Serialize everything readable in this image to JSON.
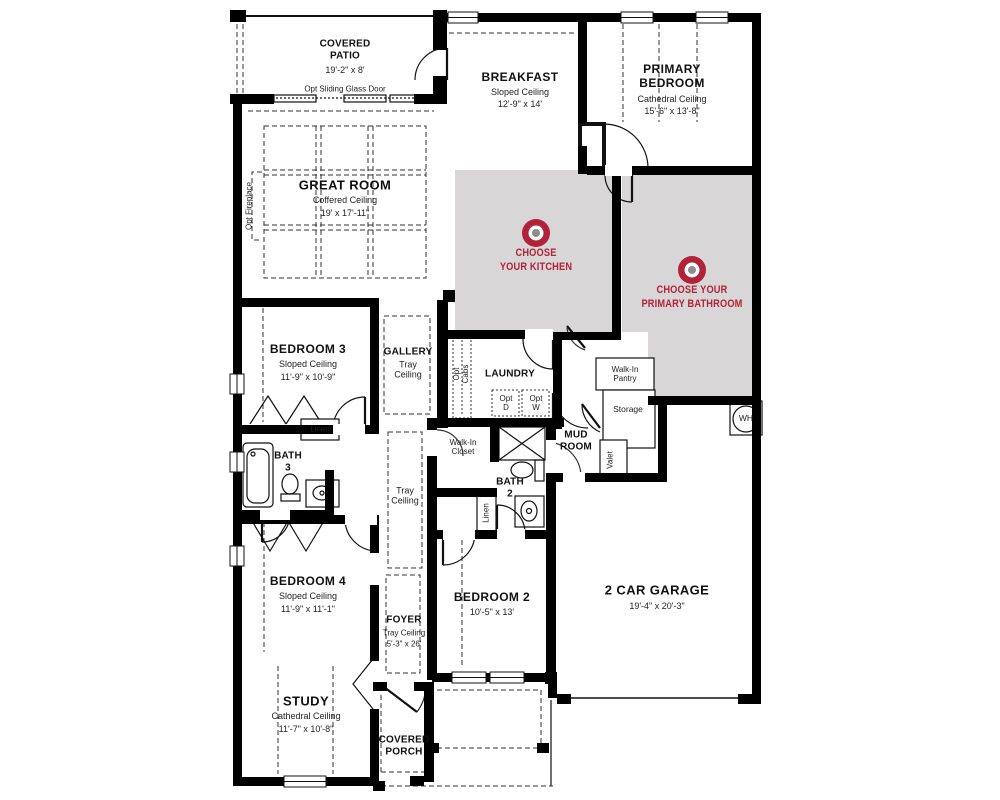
{
  "palette": {
    "wall": "#000000",
    "zone_gray": "#d9d6d8",
    "accent_red": "#b02338",
    "target_dot_gray": "#8a8f8a"
  },
  "rooms": {
    "covered_patio": {
      "name": "COVERED\nPATIO",
      "dims": "19'-2\" x 8'"
    },
    "breakfast": {
      "name": "BREAKFAST",
      "ceiling": "Sloped Ceiling",
      "dims": "12'-9\" x 14'"
    },
    "primary_bedroom": {
      "name": "PRIMARY\nBEDROOM",
      "ceiling": "Cathedral Ceiling",
      "dims": "15'-6\" x 13'-8\""
    },
    "great_room": {
      "name": "GREAT ROOM",
      "ceiling": "Coffered Ceiling",
      "dims": "19' x 17'-11\""
    },
    "bedroom3": {
      "name": "BEDROOM 3",
      "ceiling": "Sloped Ceiling",
      "dims": "11'-9\" x 10'-9\""
    },
    "gallery": {
      "name": "GALLERY",
      "ceiling": "Tray\nCeiling"
    },
    "laundry": {
      "name": "LAUNDRY"
    },
    "mud_room": {
      "name": "MUD\nROOM"
    },
    "bath3": {
      "name": "BATH\n3"
    },
    "bath2": {
      "name": "BATH\n2"
    },
    "bedroom4": {
      "name": "BEDROOM 4",
      "ceiling": "Sloped Ceiling",
      "dims": "11'-9\" x 11'-1\""
    },
    "foyer": {
      "name": "FOYER",
      "ceiling": "Tray Ceiling",
      "dims": "5'-3\" x 26'"
    },
    "bedroom2": {
      "name": "BEDROOM 2",
      "dims": "10'-5\" x 13'"
    },
    "garage": {
      "name": "2 CAR GARAGE",
      "dims": "19'-4\" x 20'-3\""
    },
    "study": {
      "name": "STUDY",
      "ceiling": "Cathedral Ceiling",
      "dims": "11'-7\" x 10'-8\""
    },
    "covered_porch": {
      "name": "COVERED\nPORCH"
    }
  },
  "features": {
    "opt_sliding_door": "Opt Sliding Glass Door",
    "opt_fireplace": "Opt Fireplace",
    "opt_cabs": "Opt\nCabs",
    "opt_dryer": "Opt\nD",
    "opt_washer": "Opt\nW",
    "walk_in_pantry": "Walk-In\nPantry",
    "storage": "Storage",
    "valet": "Valet",
    "water_heater": "WH",
    "linen_bath3": "Linen",
    "walk_in_closet": "Walk-In\nCloset",
    "linen_bath2": "Linen",
    "hall_tray": "Tray\nCeiling"
  },
  "choose_zones": {
    "kitchen": {
      "label": "CHOOSE\nYOUR KITCHEN"
    },
    "primary_bathroom": {
      "label": "CHOOSE YOUR\nPRIMARY BATHROOM"
    }
  }
}
